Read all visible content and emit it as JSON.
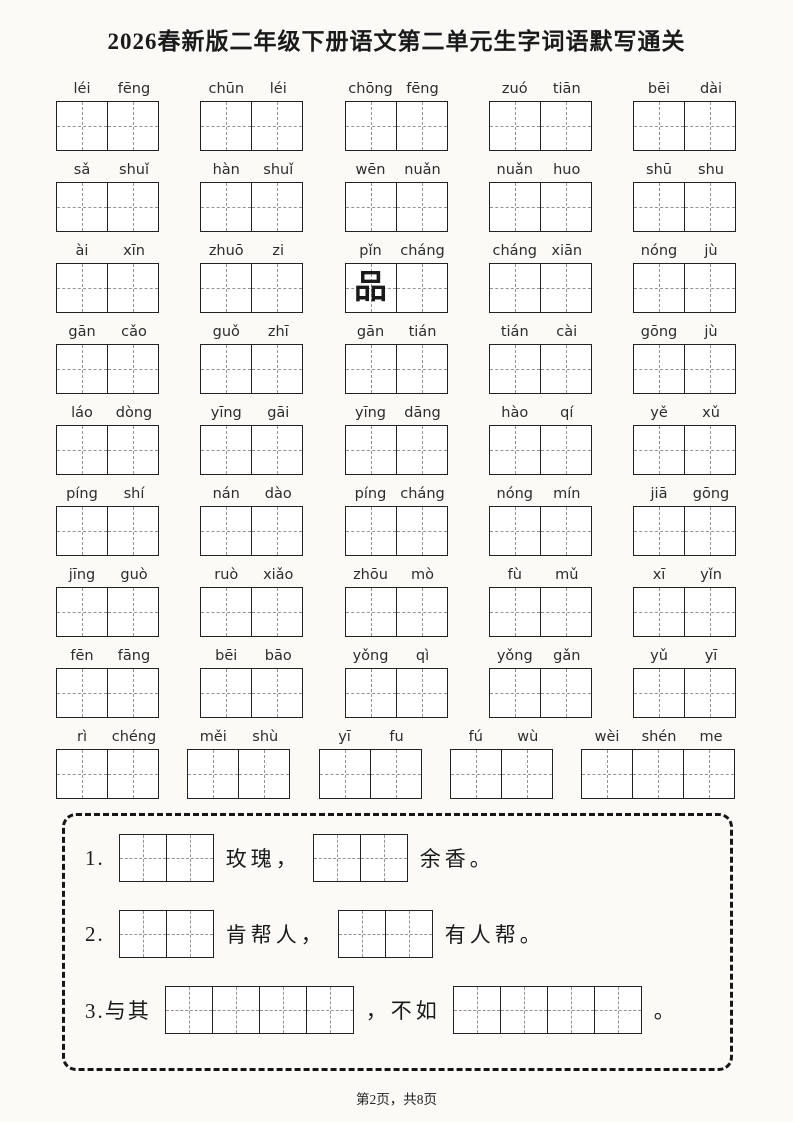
{
  "title": "2026春新版二年级下册语文第二单元生字词语默写通关",
  "word_rows": [
    [
      {
        "pinyin": [
          "léi",
          "fēng"
        ]
      },
      {
        "pinyin": [
          "chūn",
          "léi"
        ]
      },
      {
        "pinyin": [
          "chōng",
          "fēng"
        ]
      },
      {
        "pinyin": [
          "zuó",
          "tiān"
        ]
      },
      {
        "pinyin": [
          "bēi",
          "dài"
        ]
      }
    ],
    [
      {
        "pinyin": [
          "sǎ",
          "shuǐ"
        ]
      },
      {
        "pinyin": [
          "hàn",
          "shuǐ"
        ]
      },
      {
        "pinyin": [
          "wēn",
          "nuǎn"
        ]
      },
      {
        "pinyin": [
          "nuǎn",
          "huo"
        ]
      },
      {
        "pinyin": [
          "shū",
          "shu"
        ]
      }
    ],
    [
      {
        "pinyin": [
          "ài",
          "xīn"
        ]
      },
      {
        "pinyin": [
          "zhuō",
          "zi"
        ]
      },
      {
        "pinyin": [
          "pǐn",
          "cháng"
        ],
        "filled": [
          "品",
          ""
        ]
      },
      {
        "pinyin": [
          "cháng",
          "xiān"
        ]
      },
      {
        "pinyin": [
          "nóng",
          "jù"
        ]
      }
    ],
    [
      {
        "pinyin": [
          "gān",
          "cǎo"
        ]
      },
      {
        "pinyin": [
          "guǒ",
          "zhī"
        ]
      },
      {
        "pinyin": [
          "gān",
          "tián"
        ]
      },
      {
        "pinyin": [
          "tián",
          "cài"
        ]
      },
      {
        "pinyin": [
          "gōng",
          "jù"
        ]
      }
    ],
    [
      {
        "pinyin": [
          "láo",
          "dòng"
        ]
      },
      {
        "pinyin": [
          "yīng",
          "gāi"
        ]
      },
      {
        "pinyin": [
          "yīng",
          "dāng"
        ]
      },
      {
        "pinyin": [
          "hào",
          "qí"
        ]
      },
      {
        "pinyin": [
          "yě",
          "xǔ"
        ]
      }
    ],
    [
      {
        "pinyin": [
          "píng",
          "shí"
        ]
      },
      {
        "pinyin": [
          "nán",
          "dào"
        ]
      },
      {
        "pinyin": [
          "píng",
          "cháng"
        ]
      },
      {
        "pinyin": [
          "nóng",
          "mín"
        ]
      },
      {
        "pinyin": [
          "jiā",
          "gōng"
        ]
      }
    ],
    [
      {
        "pinyin": [
          "jīng",
          "guò"
        ]
      },
      {
        "pinyin": [
          "ruò",
          "xiǎo"
        ]
      },
      {
        "pinyin": [
          "zhōu",
          "mò"
        ]
      },
      {
        "pinyin": [
          "fù",
          "mǔ"
        ]
      },
      {
        "pinyin": [
          "xī",
          "yǐn"
        ]
      }
    ],
    [
      {
        "pinyin": [
          "fēn",
          "fāng"
        ]
      },
      {
        "pinyin": [
          "bēi",
          "bāo"
        ]
      },
      {
        "pinyin": [
          "yǒng",
          "qì"
        ]
      },
      {
        "pinyin": [
          "yǒng",
          "gǎn"
        ]
      },
      {
        "pinyin": [
          "yǔ",
          "yī"
        ]
      }
    ],
    [
      {
        "pinyin": [
          "rì",
          "chéng"
        ]
      },
      {
        "pinyin": [
          "měi",
          "shù"
        ]
      },
      {
        "pinyin": [
          "yī",
          "fu"
        ]
      },
      {
        "pinyin": [
          "fú",
          "wù"
        ]
      },
      {
        "pinyin": [
          "wèi",
          "shén",
          "me"
        ]
      }
    ]
  ],
  "exercises": [
    {
      "number": "1.",
      "parts": [
        {
          "boxes": 2
        },
        {
          "text": "玫瑰，"
        },
        {
          "boxes": 2
        },
        {
          "text": "余香。"
        }
      ]
    },
    {
      "number": "2.",
      "parts": [
        {
          "boxes": 2
        },
        {
          "text": "肯帮人，"
        },
        {
          "boxes": 2
        },
        {
          "text": "有人帮。"
        }
      ]
    },
    {
      "number": "3.与其",
      "parts": [
        {
          "boxes": 4
        },
        {
          "text": "，不如"
        },
        {
          "boxes": 4
        },
        {
          "text": "。"
        }
      ]
    }
  ],
  "footer": {
    "text": "第2页，共8页"
  },
  "colors": {
    "border": "#222222",
    "dash": "#949494",
    "text": "#1a1a1a"
  }
}
